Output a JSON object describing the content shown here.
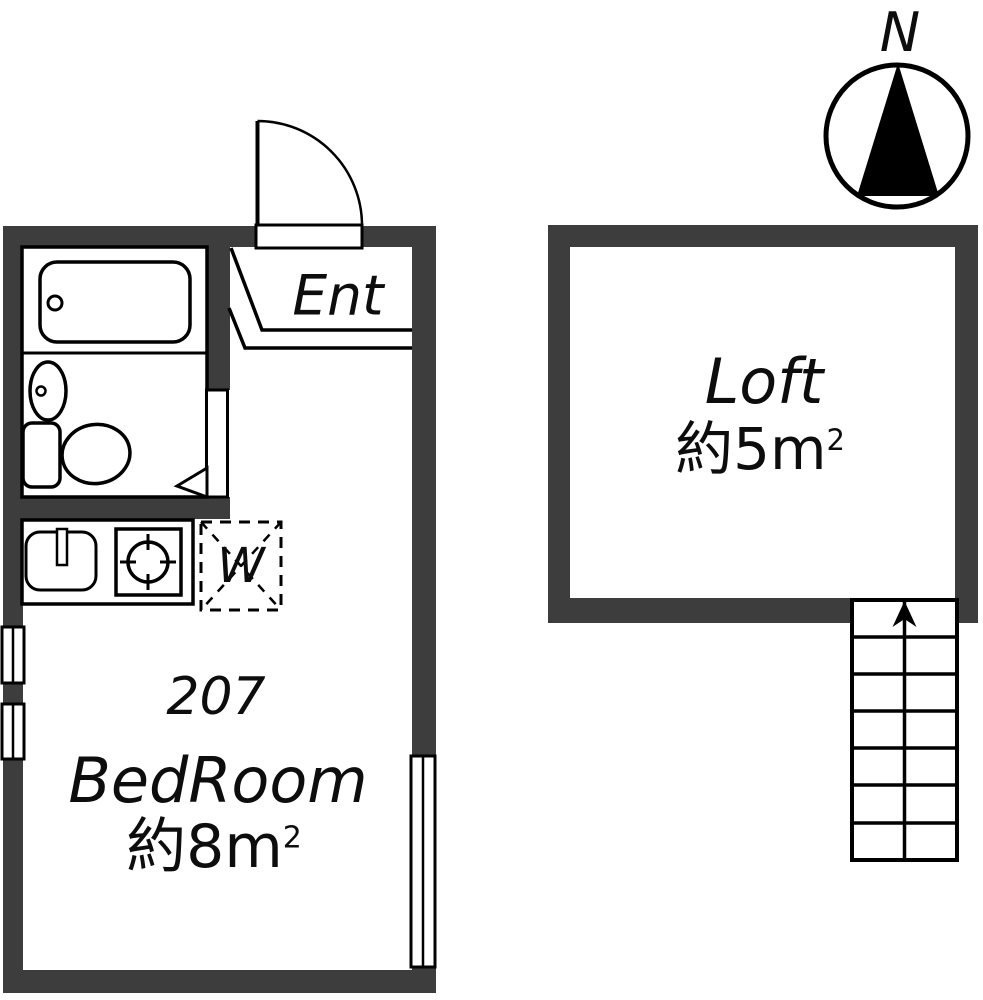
{
  "colors": {
    "wall": "#3d3d3d",
    "line": "#000000",
    "floor": "#ffffff",
    "text": "#0d0d0d"
  },
  "compass": {
    "north_label": "N"
  },
  "unit207": {
    "entrance_label": "Ent",
    "room_number": "207",
    "room_name": "BedRoom",
    "room_area": "約8m",
    "room_area_exponent": "2",
    "washer_label": "W"
  },
  "loft": {
    "name": "Loft",
    "area": "約5m",
    "area_exponent": "2"
  }
}
